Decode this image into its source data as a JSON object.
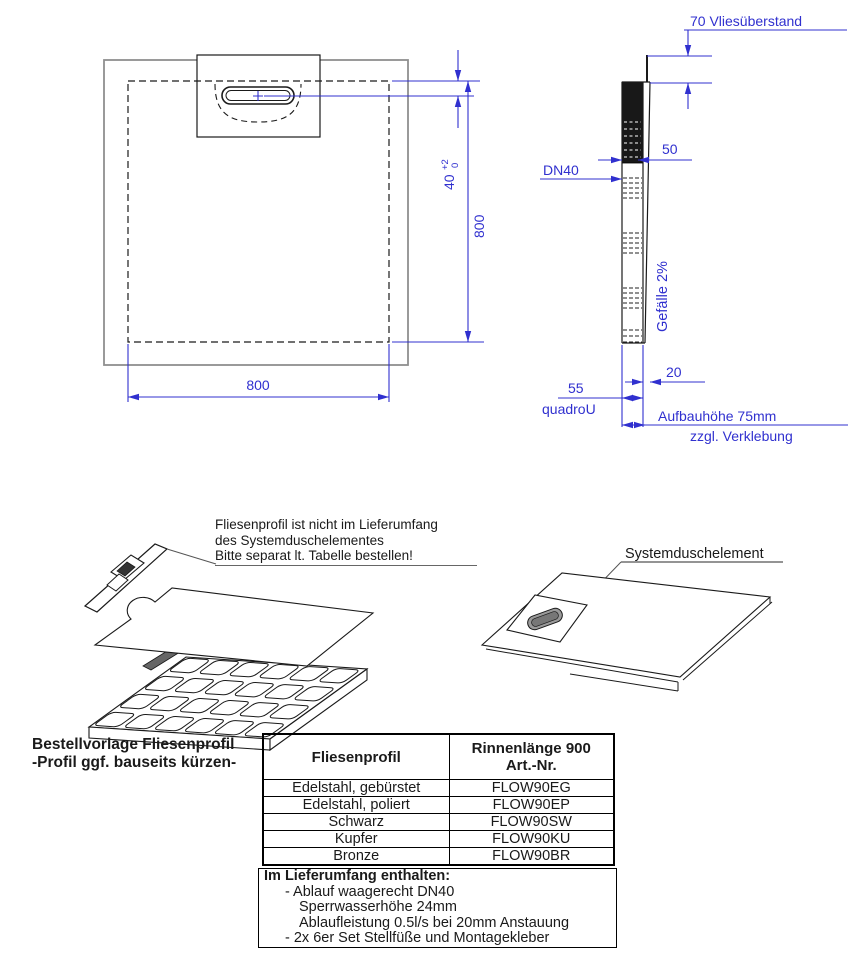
{
  "colors": {
    "dimension_blue": "#3030cf",
    "outline_gray": "#8f8f8f",
    "line_black": "#1a1a1a"
  },
  "top_view": {
    "dim_width": "800",
    "dim_height": "800",
    "dim_drain_offset": "40",
    "dim_tolerance_plus": "+2",
    "dim_tolerance_minus": "0"
  },
  "side_view": {
    "dim_fleece_overhang": "70 Vliesüberstand",
    "dim_drain_width": "50",
    "drain_label": "DN40",
    "slope_label": "Gefälle 2%",
    "dim_top_layer": "20",
    "dim_base_height": "55",
    "product_name": "quadroU",
    "build_height_line1": "Aufbauhöhe 75mm",
    "build_height_line2": "zzgl. Verklebung"
  },
  "exploded_view": {
    "note_line1": "Fliesenprofil ist nicht im Lieferumfang",
    "note_line2": "des Systemduschelementes",
    "note_line3": "Bitte separat lt. Tabelle bestellen!"
  },
  "system_view": {
    "label": "Systemduschelement"
  },
  "order_template": {
    "title_line1": "Bestellvorlage Fliesenprofil",
    "title_line2": "-Profil ggf. bauseits kürzen-"
  },
  "profile_table": {
    "col1_header": "Fliesenprofil",
    "col2_header_line1": "Rinnenlänge 900",
    "col2_header_line2": "Art.-Nr.",
    "rows": [
      {
        "profil": "Edelstahl, gebürstet",
        "art_nr": "FLOW90EG"
      },
      {
        "profil": "Edelstahl, poliert",
        "art_nr": "FLOW90EP"
      },
      {
        "profil": "Schwarz",
        "art_nr": "FLOW90SW"
      },
      {
        "profil": "Kupfer",
        "art_nr": "FLOW90KU"
      },
      {
        "profil": "Bronze",
        "art_nr": "FLOW90BR"
      }
    ]
  },
  "scope_box": {
    "title": "Im Lieferumfang enthalten:",
    "items": [
      "- Ablauf waagerecht DN40",
      "Sperrwasserhöhe 24mm",
      "Ablaufleistung 0.5l/s bei 20mm Anstauung",
      "- 2x 6er Set Stellfüße und Montagekleber"
    ]
  }
}
